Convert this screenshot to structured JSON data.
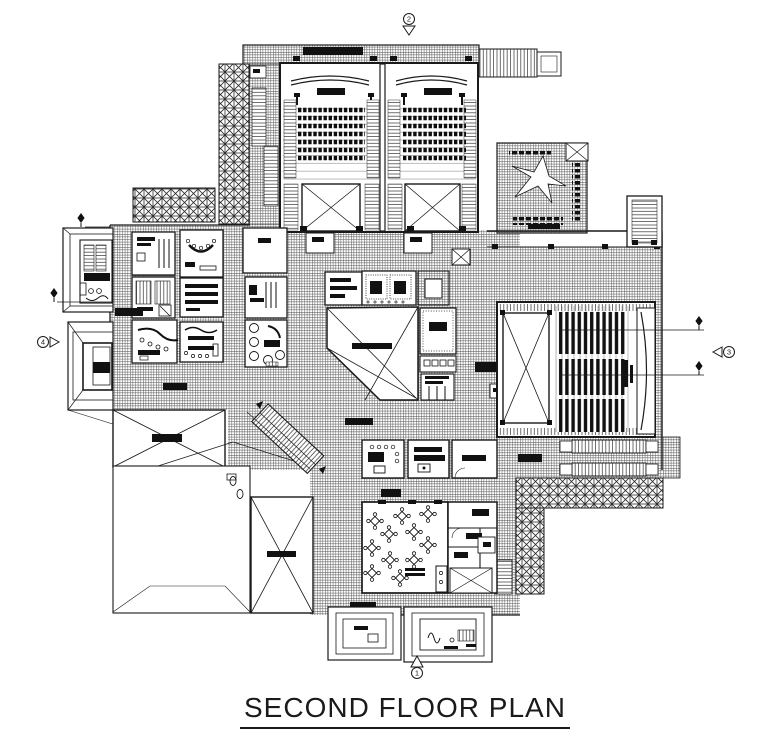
{
  "page": {
    "background": "#ffffff",
    "ink": "#1a1a1a"
  },
  "title": {
    "text": "SECOND FLOOR PLAN"
  },
  "markers": {
    "top": {
      "label": "2",
      "icon": "section-bubble-down-icon"
    },
    "bottom": {
      "label": "1",
      "icon": "section-bubble-up-icon"
    },
    "left": {
      "label": "4",
      "icon": "section-bubble-right-icon"
    },
    "right": {
      "label": "3",
      "icon": "section-bubble-left-icon"
    }
  }
}
